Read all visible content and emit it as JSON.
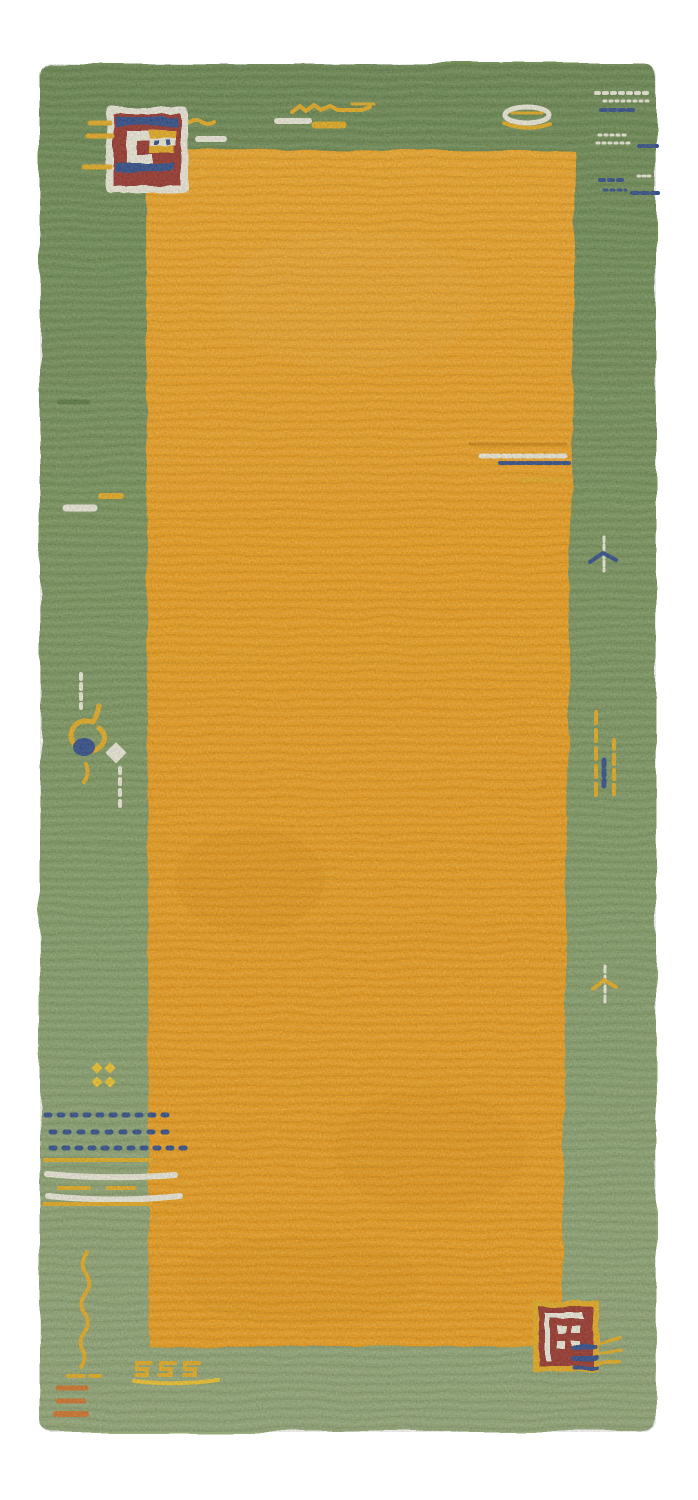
{
  "image": {
    "type": "photograph",
    "subject": "hand-knotted Gabbeh-style wool rug, portrait runner orientation on white background",
    "field_color_name": "orange",
    "border_color_name": "green",
    "colors": {
      "background": "#ffffff",
      "border_green": "#7e9a5e",
      "border_green_dark": "#5f7c44",
      "field_orange": "#f6a51a",
      "accent_cream": "#f1eedd",
      "accent_navy": "#33508d",
      "accent_maroon": "#9d392e",
      "accent_gold": "#e9af22",
      "accent_yellow": "#f3c62e",
      "accent_rust": "#d4762c"
    }
  },
  "motifs": [
    {
      "name": "medallion-top-left",
      "desc": "maroon square with navy stripes, cream outline, white hook and tiny gold/navy grid",
      "area": "top-left border"
    },
    {
      "name": "dashes-around-medallion",
      "desc": "short gold and cream dashes flanking top-left medallion",
      "area": "top-left border"
    },
    {
      "name": "zigzag-top-center",
      "desc": "gold zigzag line with cream dash and gold blob",
      "area": "top border center"
    },
    {
      "name": "oval-top-right",
      "desc": "cream oval outline crossed by gold line",
      "area": "top border right"
    },
    {
      "name": "speckles-top-right",
      "desc": "rows of cream and navy speckled dashes",
      "area": "top-right corner"
    },
    {
      "name": "dash-cluster-field-right",
      "desc": "cream, navy and gold dashed lines inside orange field",
      "area": "right side of field"
    },
    {
      "name": "dash-left-border",
      "desc": "dark green, gold and cream dashes",
      "area": "left border upper"
    },
    {
      "name": "scorpion-left",
      "desc": "gold curl with navy center, cream diamond and cream dotted lines",
      "area": "left border middle"
    },
    {
      "name": "dashed-lines-right",
      "desc": "two vertical gold dashed lines with small navy figure",
      "area": "right border middle"
    },
    {
      "name": "bird-right-upper",
      "desc": "cream stem with navy wings",
      "area": "right border"
    },
    {
      "name": "bird-right-lower",
      "desc": "cream stem with gold wings",
      "area": "right border"
    },
    {
      "name": "yellow-dots-square",
      "desc": "2x2 gold diamond dots",
      "area": "bottom-left border"
    },
    {
      "name": "dot-grid-bottom-left",
      "desc": "three rows of navy diamond dots crossing into the field",
      "area": "bottom-left"
    },
    {
      "name": "stripes-bottom-left",
      "desc": "alternating gold and cream horizontal stripes",
      "area": "bottom-left"
    },
    {
      "name": "wavy-line-bottom-left",
      "desc": "vertical gold wavy line with small feet",
      "area": "bottom-left corner"
    },
    {
      "name": "rust-dashes-bottom-left",
      "desc": "three rust-orange dashes",
      "area": "bottom-left corner"
    },
    {
      "name": "glyphs-bottom-center",
      "desc": "three small gold square-spiral glyphs over a gold underline",
      "area": "bottom border"
    },
    {
      "name": "medallion-bottom-right",
      "desc": "maroon square with gold border, cream inner frame and four cream squares, navy dashes and gold squiggles at right",
      "area": "bottom-right border"
    }
  ]
}
